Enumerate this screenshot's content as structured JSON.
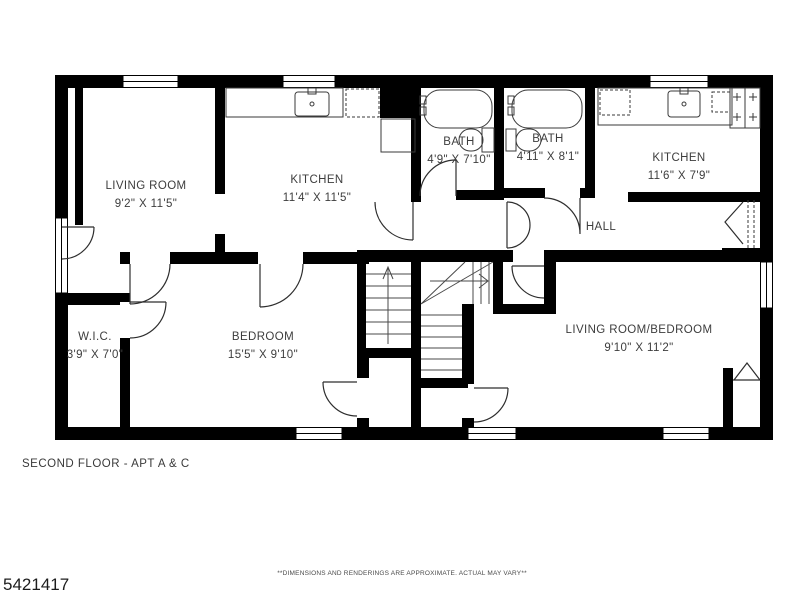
{
  "plan": {
    "title": "SECOND FLOOR - APT A & C",
    "listing_id": "5421417",
    "disclaimer": "**DIMENSIONS AND RENDERINGS ARE APPROXIMATE. ACTUAL MAY VARY**",
    "rooms": {
      "living_room": {
        "name": "LIVING ROOM",
        "dims": "9'2\" X 11'5\""
      },
      "kitchen_left": {
        "name": "KITCHEN",
        "dims": "11'4\" X 11'5\""
      },
      "bath_left": {
        "name": "BATH",
        "dims": "4'9\" X 7'10\""
      },
      "bath_right": {
        "name": "BATH",
        "dims": "4'11\" X 8'1\""
      },
      "kitchen_right": {
        "name": "KITCHEN",
        "dims": "11'6\" X 7'9\""
      },
      "hall": {
        "name": "HALL"
      },
      "wic": {
        "name": "W.I.C.",
        "dims": "3'9\" X 7'0\""
      },
      "bedroom": {
        "name": "BEDROOM",
        "dims": "15'5\" X 9'10\""
      },
      "living_room_bedroom": {
        "name": "LIVING ROOM/BEDROOM",
        "dims": "9'10\" X 11'2\""
      }
    },
    "colors": {
      "wall": "#000000",
      "line": "#2e2e2e",
      "text": "#3d3d3d",
      "bg": "#ffffff"
    }
  }
}
